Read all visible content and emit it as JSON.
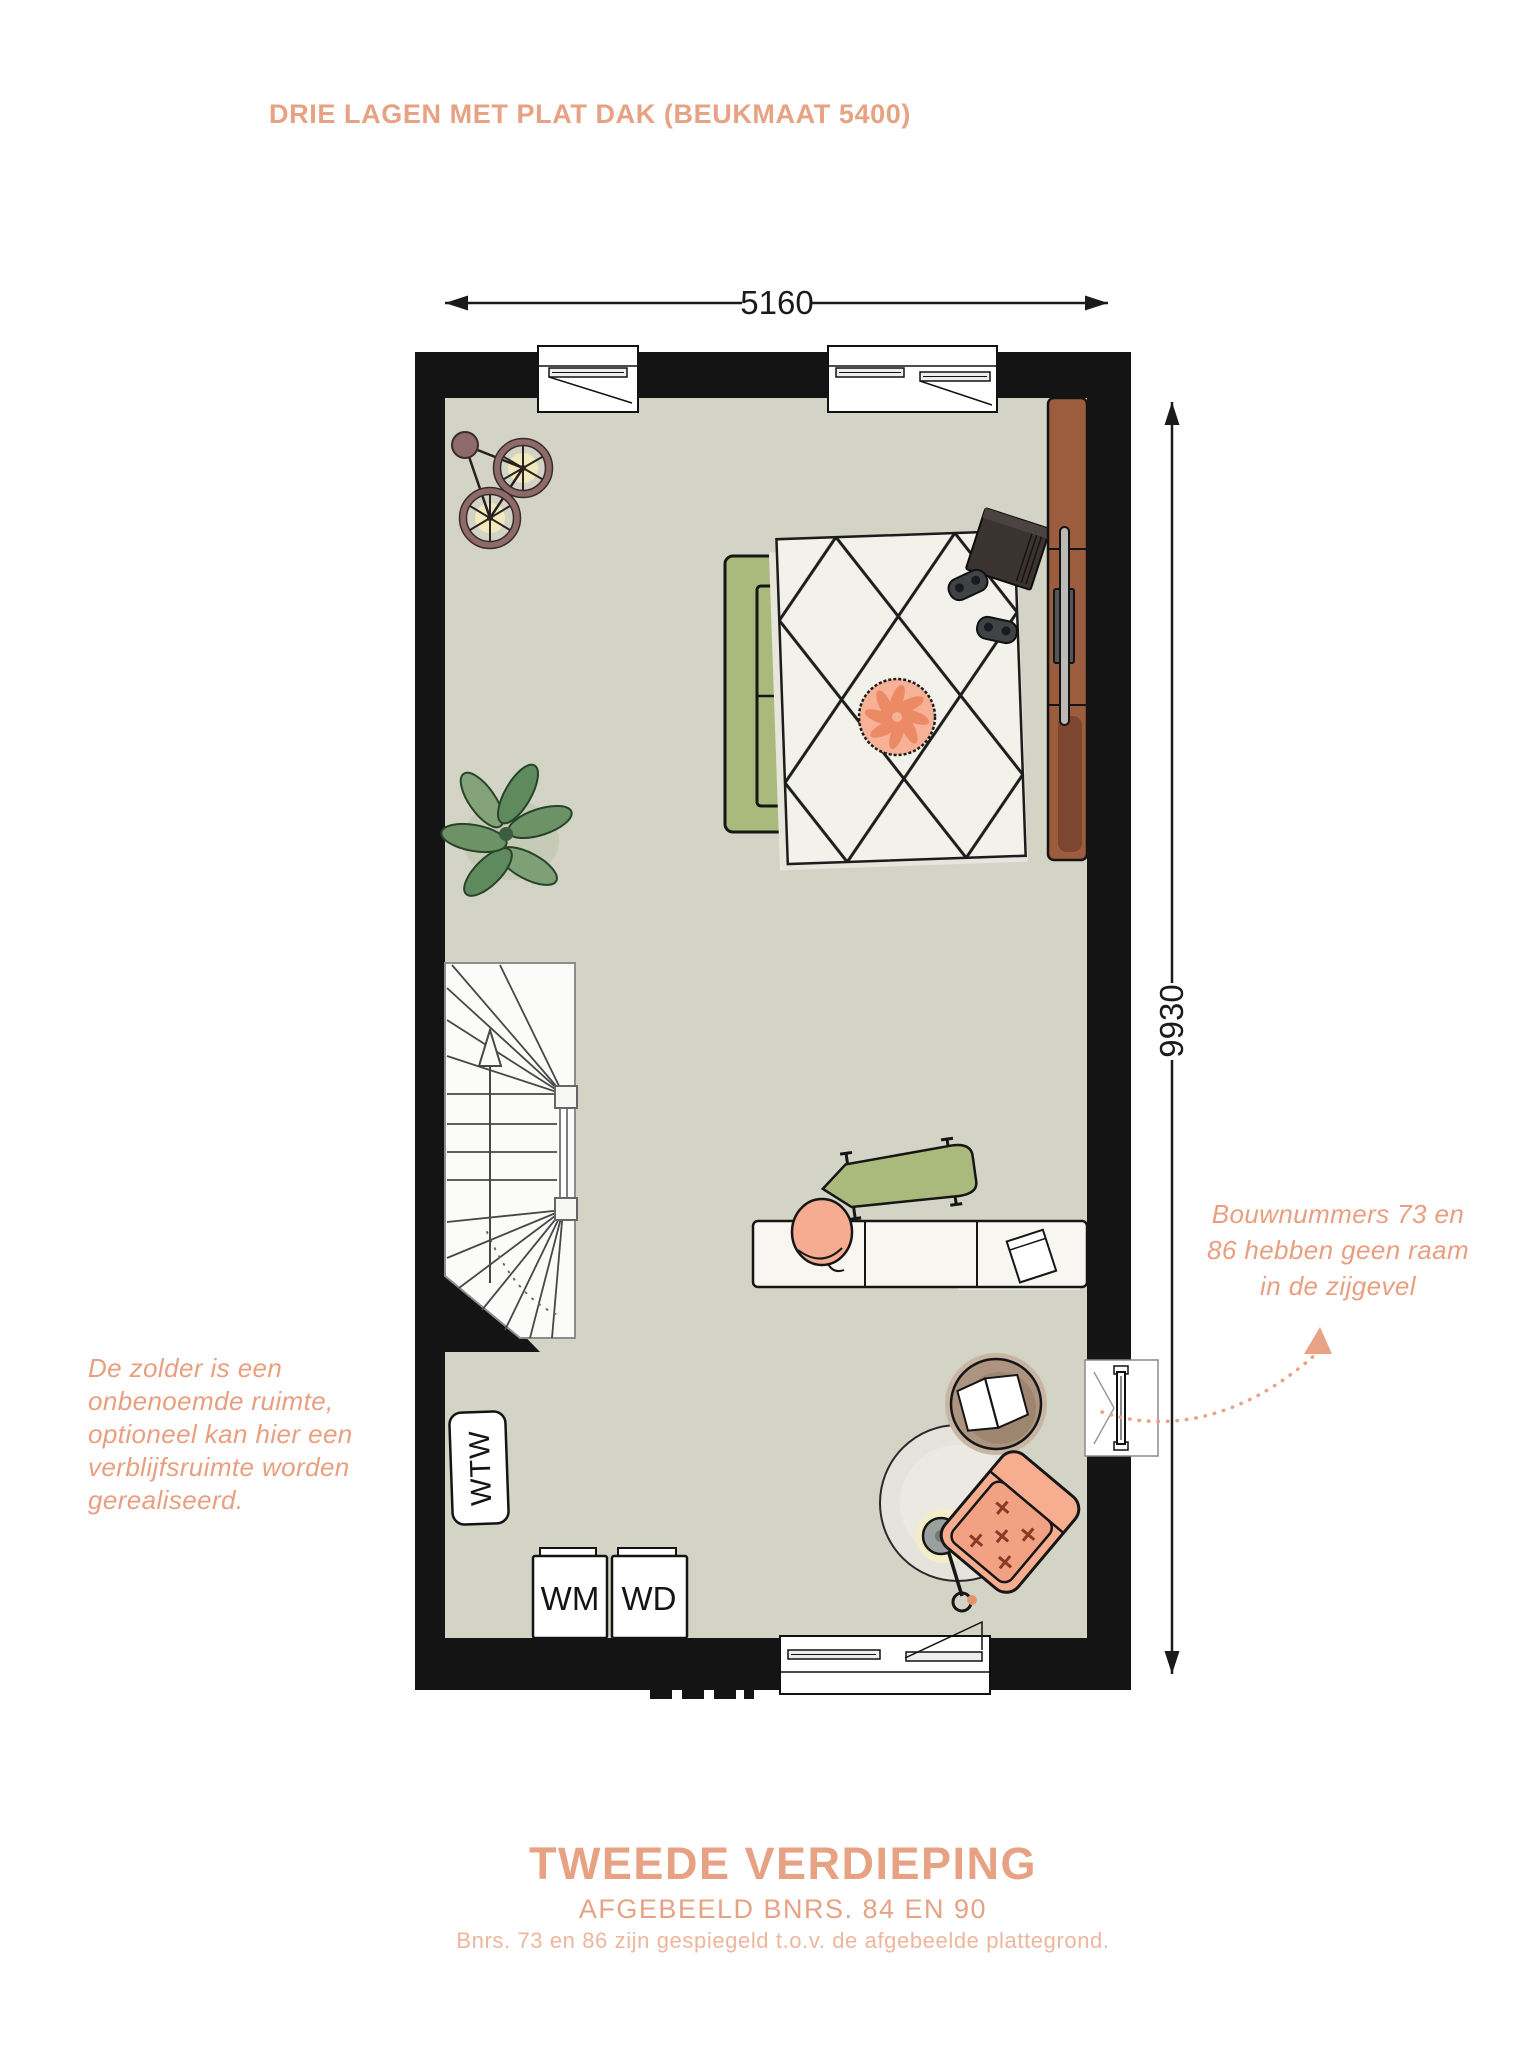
{
  "page": {
    "title": "DRIE LAGEN MET PLAT DAK (BEUKMAAT 5400)",
    "floor_name": "TWEEDE VERDIEPING",
    "subtitle": "AFGEBEELD BNRS. 84 EN 90",
    "footnote": "Bnrs. 73 en 86 zijn gespiegeld t.o.v. de afgebeelde plattegrond."
  },
  "dimensions": {
    "width_label": "5160",
    "height_label": "9930"
  },
  "labels": {
    "wtw": "WTW",
    "wm": "WM",
    "wd": "WD"
  },
  "notes": {
    "left": {
      "lines": [
        "De zolder is een",
        "onbenoemde ruimte,",
        "optioneel kan hier een",
        "verblijfsruimte worden",
        "gerealiseerd."
      ]
    },
    "right": {
      "lines": [
        "Bouwnummers 73 en",
        "86 hebben geen raam",
        "in de zijgevel"
      ]
    }
  },
  "colors": {
    "accent_salmon": "#e7a284",
    "handwriting_salmon": "#e99f7f",
    "wall_black": "#141414",
    "floor_sage": "#d3d4c5",
    "sofa_green": "#a9ba7c",
    "rug_cream": "#f2f1ea",
    "cabinet_brown": "#9c5c3e",
    "pouf_salmon": "#f6b197",
    "armchair_salmon": "#f6ad90"
  }
}
